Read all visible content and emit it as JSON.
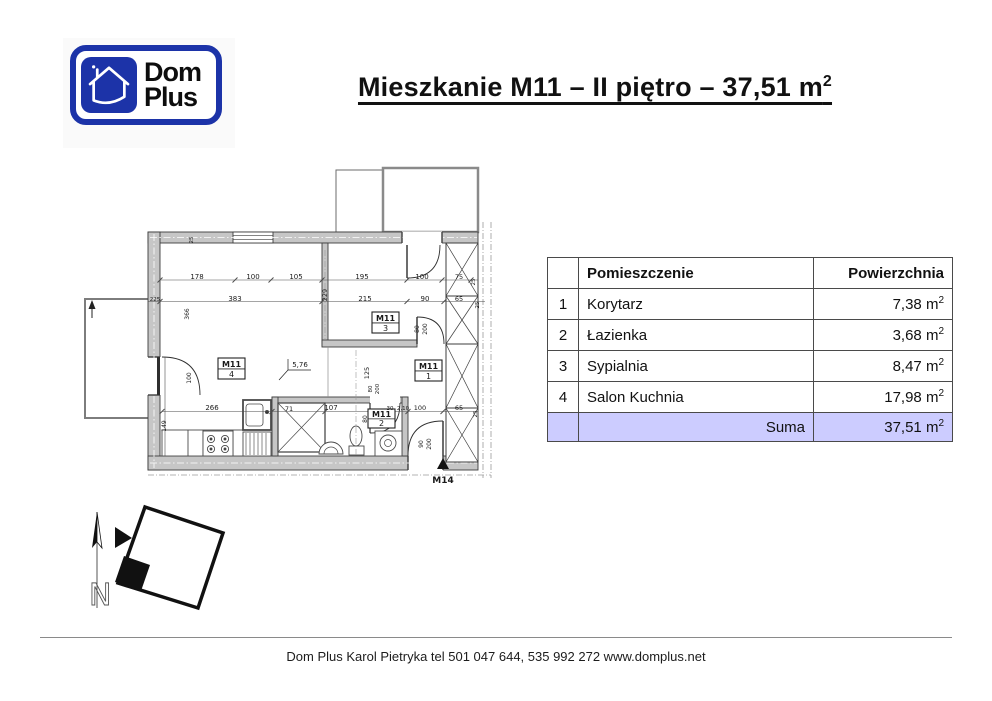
{
  "logo": {
    "line1": "Dom",
    "line2": "Plus",
    "brand_blue": "#1c33a8"
  },
  "title": {
    "text": "Mieszkanie M11 – II piętro – 37,51 m",
    "sup": "2"
  },
  "table": {
    "headers": {
      "index": "",
      "room": "Pomieszczenie",
      "area": "Powierzchnia"
    },
    "rows": [
      {
        "no": "1",
        "room": "Korytarz",
        "area": "7,38"
      },
      {
        "no": "2",
        "room": "Łazienka",
        "area": "3,68"
      },
      {
        "no": "3",
        "room": "Sypialnia",
        "area": "8,47"
      },
      {
        "no": "4",
        "room": "Salon Kuchnia",
        "area": "17,98"
      }
    ],
    "area_unit": "m",
    "area_sup": "2",
    "sum": {
      "label": "Suma",
      "area": "37,51"
    },
    "sum_row_bg": "#ccccff"
  },
  "plan": {
    "room_labels": [
      {
        "l1": "M11",
        "l2": "3",
        "x": 297,
        "y": 152,
        "w": 27,
        "h": 21
      },
      {
        "l1": "M11",
        "l2": "4",
        "x": 143,
        "y": 198,
        "w": 27,
        "h": 21
      },
      {
        "l1": "M11",
        "l2": "1",
        "x": 340,
        "y": 200,
        "w": 27,
        "h": 21
      },
      {
        "l1": "M11",
        "l2": "2",
        "x": 293,
        "y": 249,
        "w": 27,
        "h": 19
      }
    ],
    "dim_labels": [
      {
        "t": "178",
        "x": 122,
        "y": 119,
        "r": 0,
        "s": 7
      },
      {
        "t": "100",
        "x": 178,
        "y": 119,
        "r": 0,
        "s": 7
      },
      {
        "t": "105",
        "x": 221,
        "y": 119,
        "r": 0,
        "s": 7
      },
      {
        "t": "195",
        "x": 287,
        "y": 119,
        "r": 0,
        "s": 7
      },
      {
        "t": "100",
        "x": 347,
        "y": 119,
        "r": 0,
        "s": 7
      },
      {
        "t": "75",
        "x": 384,
        "y": 119,
        "r": 0,
        "s": 6.5
      },
      {
        "t": "25",
        "x": 400,
        "y": 122,
        "r": -90,
        "s": 5.5
      },
      {
        "t": "25",
        "x": 118,
        "y": 80,
        "r": -90,
        "s": 5.5
      },
      {
        "t": "225",
        "x": 80,
        "y": 141,
        "r": 0,
        "s": 5.5
      },
      {
        "t": "366",
        "x": 114,
        "y": 154,
        "r": -90,
        "s": 6
      },
      {
        "t": "383",
        "x": 160,
        "y": 141,
        "r": 0,
        "s": 7
      },
      {
        "t": "229",
        "x": 252,
        "y": 135,
        "r": -90,
        "s": 6.5
      },
      {
        "t": "215",
        "x": 290,
        "y": 141,
        "r": 0,
        "s": 7
      },
      {
        "t": "90",
        "x": 350,
        "y": 141,
        "r": 0,
        "s": 7
      },
      {
        "t": "65",
        "x": 384,
        "y": 141,
        "r": 0,
        "s": 6.5
      },
      {
        "t": "25",
        "x": 404,
        "y": 145,
        "r": -90,
        "s": 5.5
      },
      {
        "t": "266",
        "x": 137,
        "y": 250,
        "r": 0,
        "s": 7
      },
      {
        "t": "71",
        "x": 214,
        "y": 251,
        "r": 0,
        "s": 6.5
      },
      {
        "t": "107",
        "x": 256,
        "y": 250,
        "r": 0,
        "s": 7
      },
      {
        "t": "80",
        "x": 292,
        "y": 259,
        "r": -90,
        "s": 6
      },
      {
        "t": "30",
        "x": 315,
        "y": 250,
        "r": 0,
        "s": 5.5
      },
      {
        "t": "2,10",
        "x": 328,
        "y": 250,
        "r": 0,
        "s": 5.5
      },
      {
        "t": "100",
        "x": 345,
        "y": 250,
        "r": 0,
        "s": 6.5
      },
      {
        "t": "65",
        "x": 384,
        "y": 250,
        "r": 0,
        "s": 6.5
      },
      {
        "t": "25",
        "x": 402,
        "y": 254,
        "r": -90,
        "s": 5.5
      },
      {
        "t": "149",
        "x": 91,
        "y": 266,
        "r": -90,
        "s": 6
      },
      {
        "t": "100",
        "x": 116,
        "y": 218,
        "r": -90,
        "s": 6
      },
      {
        "t": "125",
        "x": 294,
        "y": 213,
        "r": -90,
        "s": 6.5
      },
      {
        "t": "80",
        "x": 344,
        "y": 169,
        "r": -90,
        "s": 6
      },
      {
        "t": "200",
        "x": 352,
        "y": 169,
        "r": -90,
        "s": 6
      },
      {
        "t": "80",
        "x": 297,
        "y": 229,
        "r": -90,
        "s": 5.5
      },
      {
        "t": "200",
        "x": 304,
        "y": 229,
        "r": -90,
        "s": 5.5
      },
      {
        "t": "90",
        "x": 348,
        "y": 284,
        "r": -90,
        "s": 6
      },
      {
        "t": "200",
        "x": 356,
        "y": 284,
        "r": -90,
        "s": 6
      }
    ],
    "level_mark": "5,76",
    "marker": "M14"
  },
  "compass": {
    "north_label": "N"
  },
  "footer": {
    "text": "Dom Plus Karol Pietryka tel 501 047 644, 535 992 272 www.domplus.net"
  }
}
